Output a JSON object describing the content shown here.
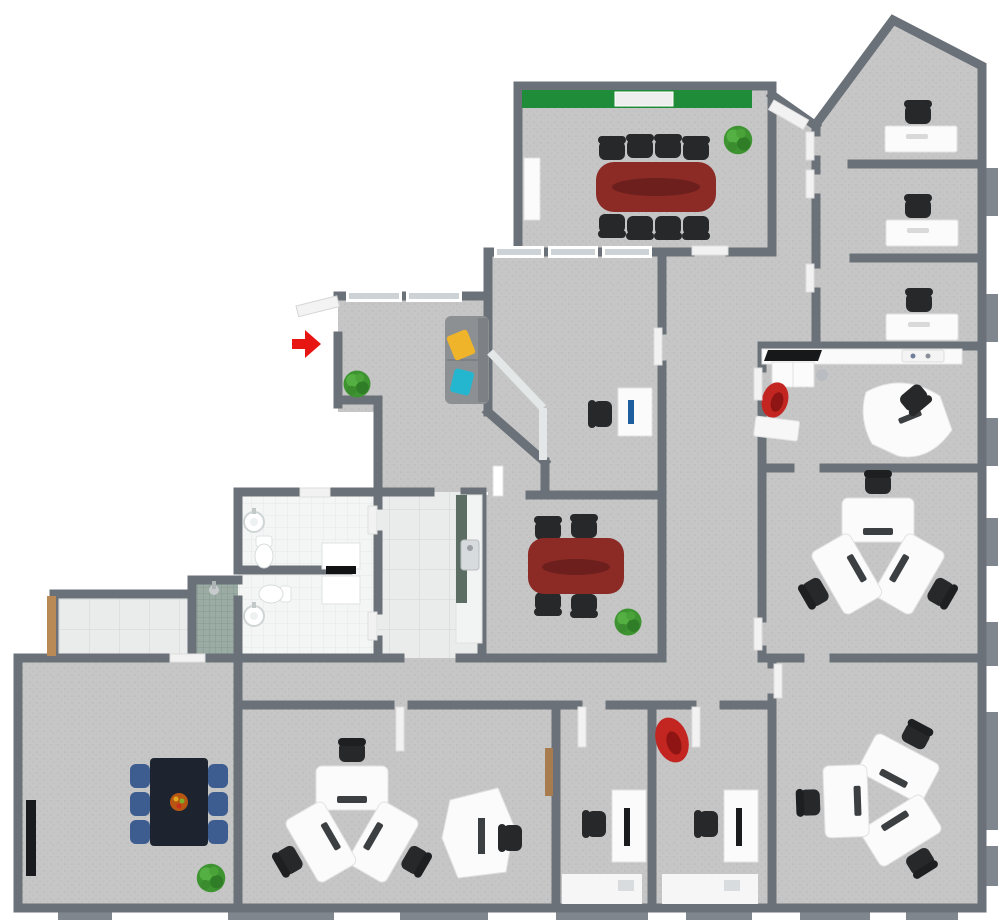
{
  "meta": {
    "type": "3d-office-floor-plan",
    "view": "top-down-render",
    "visible_text": "none"
  },
  "palette": {
    "wall": "#6b7178",
    "wall_dark": "#5f656c",
    "carpet": "#c6c6c6",
    "carpet_dot": "#b8b8b8",
    "floor_tile": "#e9eceb",
    "bath_tile": "#f4f6f6",
    "shower_mosaic": "#9aaca4",
    "accent_wall_green": "#1f8c3a",
    "table_mahogany": "#8c2b26",
    "table_mahogany_dark": "#6c1f1c",
    "chair_black": "#26282a",
    "chair_blue": "#3d5c8f",
    "desk_white": "#fbfbfb",
    "desk_edge": "#e2e2e2",
    "plant_green": "#3f9432",
    "entrance_arrow_red": "#e81613",
    "sofa_gray": "#8d9093",
    "pillow_yellow": "#f0b42a",
    "pillow_cyan": "#25b6cf",
    "armchair_red": "#c32521",
    "door_wood": "#b98a56",
    "glass": "#ccd2d6",
    "counter_splash": "#5c6e64",
    "break_table_dark": "#1d2430",
    "fruit_bowl": "#b65612",
    "metal": "#b9bdc1",
    "monitor_dark": "#3c3f42"
  },
  "entrance": {
    "marker": "red-arrow",
    "position": "left-middle",
    "direction": "pointing-right-into-door"
  },
  "rooms": [
    {
      "name": "conference-room-large",
      "accent_wall": "green",
      "furniture": [
        "mahogany-conference-table",
        "8-black-chairs",
        "whiteboard",
        "credenza",
        "plant"
      ]
    },
    {
      "name": "private-office-1",
      "furniture": [
        "white-desk",
        "black-task-chair"
      ]
    },
    {
      "name": "private-office-2",
      "furniture": [
        "white-desk",
        "black-task-chair"
      ]
    },
    {
      "name": "private-office-3",
      "furniture": [
        "white-desk",
        "black-task-chair"
      ]
    },
    {
      "name": "executive-office",
      "furniture": [
        "wall-counter",
        "printer",
        "tray",
        "cabinet",
        "trash-can",
        "red-armchair",
        "curved-desk",
        "black-task-chair",
        "wall-shelf"
      ]
    },
    {
      "name": "team-office-right",
      "furniture": [
        "3-person-workstation-pod"
      ]
    },
    {
      "name": "team-office-bottom-right",
      "furniture": [
        "3-person-workstation-pod"
      ]
    },
    {
      "name": "open-office-bottom",
      "furniture": [
        "3-person-workstation-pod",
        "curved-single-desk",
        "black-task-chair"
      ]
    },
    {
      "name": "small-office-bottom-1",
      "furniture": [
        "white-desk-with-monitor",
        "black-task-chair",
        "window-bay"
      ]
    },
    {
      "name": "small-office-bottom-2",
      "furniture": [
        "white-desk-with-monitor",
        "black-task-chair",
        "red-beanbag-chair",
        "window-bay"
      ]
    },
    {
      "name": "break-room",
      "furniture": [
        "dark-dining-table",
        "6-blue-chairs",
        "fruit-bowl",
        "plant",
        "radiator"
      ]
    },
    {
      "name": "meeting-room-small",
      "furniture": [
        "mahogany-meeting-table",
        "4-black-chairs",
        "plant"
      ]
    },
    {
      "name": "lounge-reception",
      "furniture": [
        "gray-sofa",
        "yellow-pillow",
        "cyan-pillow",
        "plant"
      ]
    },
    {
      "name": "reception-office-nook",
      "furniture": [
        "white-desk",
        "blue-monitor",
        "black-task-chair"
      ]
    },
    {
      "name": "restroom-upper",
      "fixtures": [
        "toilet",
        "round-wall-sink",
        "double-vanity"
      ]
    },
    {
      "name": "restroom-lower",
      "fixtures": [
        "toilet",
        "round-wall-sink",
        "double-vanity"
      ]
    },
    {
      "name": "shower-room",
      "fixtures": [
        "mosaic-shower",
        "shower-head"
      ]
    },
    {
      "name": "kitchenette-strip",
      "fixtures": [
        "cabinet-run",
        "stainless-sink",
        "green-backsplash"
      ]
    },
    {
      "name": "entry-corridor",
      "fixtures": [
        "wooden-entry-door",
        "tile-floor"
      ]
    }
  ],
  "furniture_counts": {
    "conference_seats": 8,
    "small_meeting_seats": 4,
    "workstation_pods": 3,
    "desks_per_pod": 3,
    "private_office_desks": 3,
    "bottom_small_office_desks": 2,
    "break_table_seats_blue": 6,
    "toilets": 2,
    "round_sinks": 2,
    "vanity_sinks": 2,
    "showers": 1,
    "sofas": 1,
    "plants": 5,
    "red_chairs": 2
  }
}
